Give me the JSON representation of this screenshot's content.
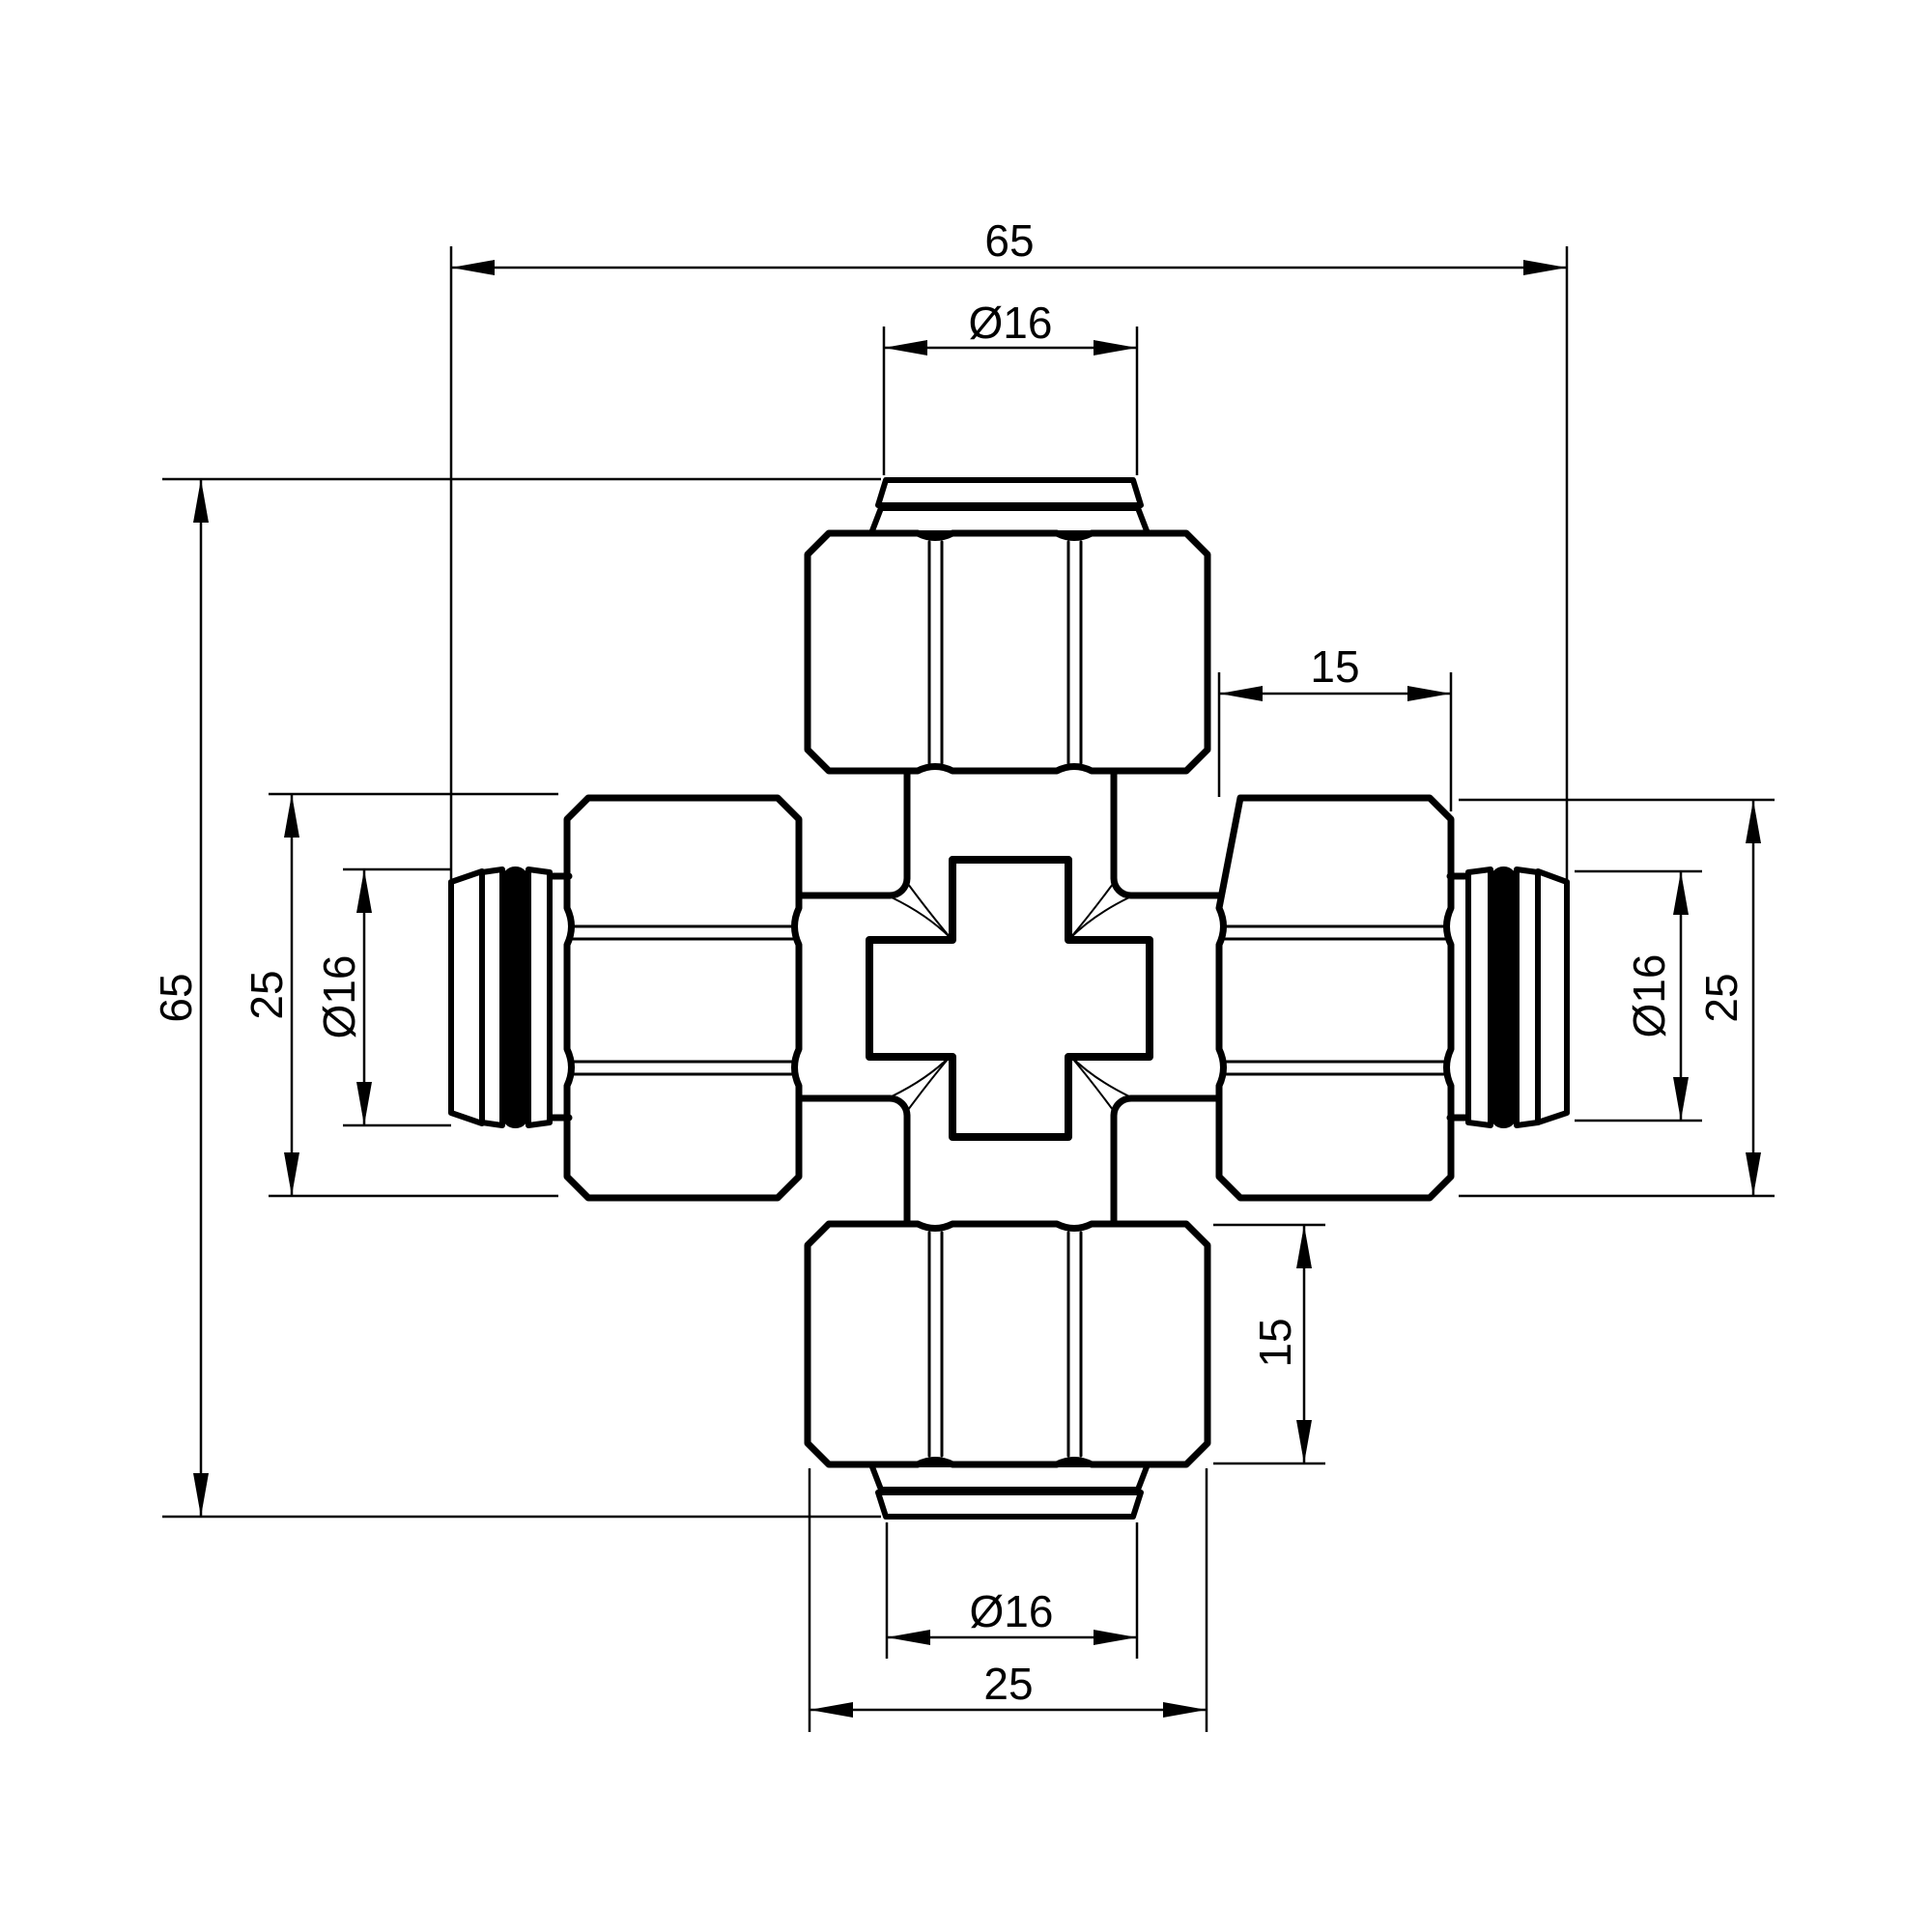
{
  "drawing": {
    "type": "technical-drawing",
    "subject": "4-way cross compression fitting, front view",
    "background_color": "#ffffff",
    "line_color": "#000000",
    "oring_color": "#000000",
    "dims": {
      "top_width": "65",
      "top_diameter": "Ø16",
      "top_right_depth": "15",
      "left_height": "65",
      "left_width": "25",
      "left_diameter": "Ø16",
      "right_diameter": "Ø16",
      "right_width": "25",
      "bottom_depth": "15",
      "bottom_diameter": "Ø16",
      "bottom_width": "25"
    }
  }
}
